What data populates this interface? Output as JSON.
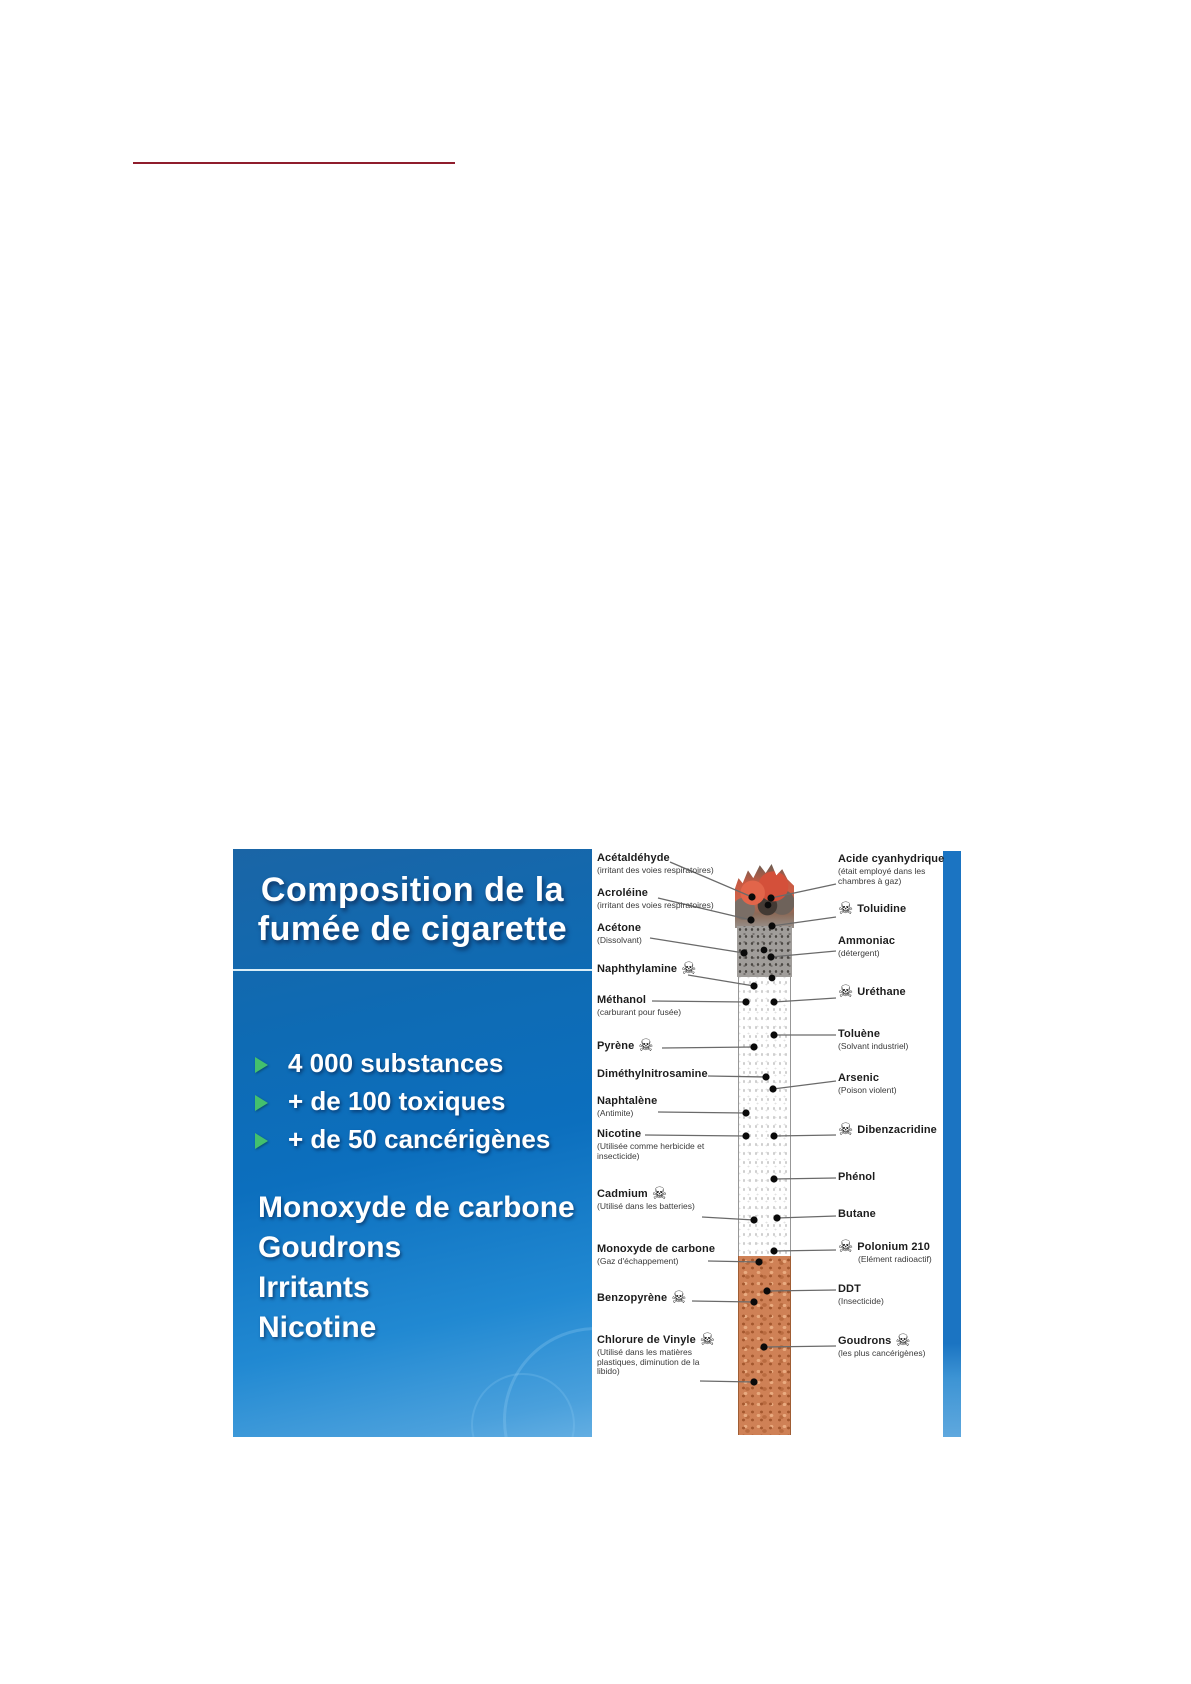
{
  "page": {
    "background": "#ffffff"
  },
  "top_rule": {
    "color": "#8f1d2c"
  },
  "slide": {
    "title": {
      "line1": "Composition de la",
      "line2": "fumée de cigarette"
    },
    "bullets": [
      "4 000 substances",
      "+ de 100 toxiques",
      "+ de 50 cancérigènes"
    ],
    "list": [
      "Monoxyde de carbone",
      "Goudrons",
      "Irritants",
      "Nicotine"
    ],
    "colors": {
      "panel_top": "#1a65a6",
      "panel_mid": "#0c6fbe",
      "panel_bottom": "#4aa0dc",
      "divider": "#d9eef8",
      "bullet_arrow": "#43c06e",
      "right_strip": "#1b74c2",
      "connector": "#6a6a6a",
      "dot": "#0a0a0a"
    }
  },
  "diagram": {
    "skull_glyph": "☠",
    "left_labels": [
      {
        "name": "Acétaldéhyde",
        "sub": [
          "(irritant des voies respiratoires)"
        ],
        "skull": false,
        "x": 597,
        "y": 852,
        "line": [
          670,
          862,
          752,
          897
        ]
      },
      {
        "name": "Acroléine",
        "sub": [
          "(irritant des voies respiratoires)"
        ],
        "skull": false,
        "x": 597,
        "y": 887,
        "line": [
          658,
          898,
          751,
          920
        ]
      },
      {
        "name": "Acétone",
        "sub": [
          "(Dissolvant)"
        ],
        "skull": false,
        "x": 597,
        "y": 922,
        "line": [
          650,
          938,
          744,
          953
        ]
      },
      {
        "name": "Naphthylamine",
        "sub": [],
        "skull": true,
        "x": 597,
        "y": 963,
        "line": [
          688,
          975,
          754,
          986
        ]
      },
      {
        "name": "Méthanol",
        "sub": [
          "(carburant pour fusée)"
        ],
        "skull": false,
        "x": 597,
        "y": 994,
        "line": [
          652,
          1001,
          746,
          1002
        ]
      },
      {
        "name": "Pyrène",
        "sub": [],
        "skull": true,
        "x": 597,
        "y": 1040,
        "line": [
          662,
          1048,
          754,
          1047
        ]
      },
      {
        "name": "Diméthylnitrosamine",
        "sub": [],
        "skull": false,
        "x": 597,
        "y": 1068,
        "line": [
          708,
          1076,
          766,
          1077
        ]
      },
      {
        "name": "Naphtalène",
        "sub": [
          "(Antimite)"
        ],
        "skull": false,
        "x": 597,
        "y": 1095,
        "line": [
          658,
          1112,
          746,
          1113
        ]
      },
      {
        "name": "Nicotine",
        "sub": [
          "(Utilisée comme herbicide et",
          "insecticide)"
        ],
        "skull": false,
        "x": 597,
        "y": 1128,
        "line": [
          645,
          1135,
          746,
          1136
        ]
      },
      {
        "name": "Cadmium",
        "sub": [
          "(Utilisé dans les batteries)"
        ],
        "skull": true,
        "x": 597,
        "y": 1188,
        "line": [
          702,
          1217,
          754,
          1220
        ]
      },
      {
        "name": "Monoxyde de carbone",
        "sub": [
          "(Gaz d'échappement)"
        ],
        "skull": false,
        "x": 597,
        "y": 1243,
        "line": [
          708,
          1261,
          759,
          1262
        ]
      },
      {
        "name": "Benzopyrène",
        "sub": [],
        "skull": true,
        "x": 597,
        "y": 1292,
        "line": [
          692,
          1301,
          754,
          1302
        ]
      },
      {
        "name": "Chlorure de Vinyle",
        "sub": [
          "(Utilisé dans les matières",
          "plastiques, diminution de la",
          "libido)"
        ],
        "skull": true,
        "x": 597,
        "y": 1334,
        "line": [
          700,
          1381,
          754,
          1382
        ]
      }
    ],
    "right_labels": [
      {
        "name": "Acide cyanhydrique",
        "sub": [
          "(était employé dans les",
          "chambres à gaz)"
        ],
        "skull": false,
        "x": 838,
        "y": 853,
        "line": [
          836,
          884,
          771,
          898
        ]
      },
      {
        "name": "Toluidine",
        "sub": [],
        "skull": true,
        "x": 838,
        "y": 903,
        "line": [
          836,
          917,
          772,
          926
        ]
      },
      {
        "name": "Ammoniac",
        "sub": [
          "(détergent)"
        ],
        "skull": false,
        "x": 838,
        "y": 935,
        "line": [
          836,
          951,
          771,
          957
        ]
      },
      {
        "name": "Uréthane",
        "sub": [],
        "skull": true,
        "x": 838,
        "y": 986,
        "line": [
          836,
          998,
          774,
          1002
        ]
      },
      {
        "name": "Toluène",
        "sub": [
          "(Solvant industriel)"
        ],
        "skull": false,
        "x": 838,
        "y": 1028,
        "line": [
          836,
          1035,
          774,
          1035
        ]
      },
      {
        "name": "Arsenic",
        "sub": [
          "(Poison violent)"
        ],
        "skull": false,
        "x": 838,
        "y": 1072,
        "line": [
          836,
          1081,
          773,
          1089
        ]
      },
      {
        "name": "Dibenzacridine",
        "sub": [],
        "skull": true,
        "x": 838,
        "y": 1124,
        "line": [
          836,
          1135,
          774,
          1136
        ]
      },
      {
        "name": "Phénol",
        "sub": [],
        "skull": false,
        "x": 838,
        "y": 1171,
        "line": [
          836,
          1178,
          774,
          1179
        ]
      },
      {
        "name": "Butane",
        "sub": [],
        "skull": false,
        "x": 838,
        "y": 1208,
        "line": [
          836,
          1216,
          777,
          1218
        ]
      },
      {
        "name": "Polonium 210",
        "sub": [
          "(Elément radioactif)"
        ],
        "sub_indent": true,
        "skull": true,
        "x": 838,
        "y": 1241,
        "line": [
          836,
          1250,
          774,
          1251
        ]
      },
      {
        "name": "DDT",
        "sub": [
          "(Insecticide)"
        ],
        "skull": false,
        "x": 838,
        "y": 1283,
        "line": [
          836,
          1290,
          767,
          1291
        ]
      },
      {
        "name": "Goudrons",
        "sub": [
          "(les plus cancérigènes)"
        ],
        "skull": true,
        "skull_side": "right",
        "x": 838,
        "y": 1335,
        "line": [
          836,
          1346,
          764,
          1347
        ]
      }
    ],
    "extra_dots": [
      [
        768,
        905
      ],
      [
        764,
        950
      ],
      [
        772,
        978
      ]
    ]
  }
}
